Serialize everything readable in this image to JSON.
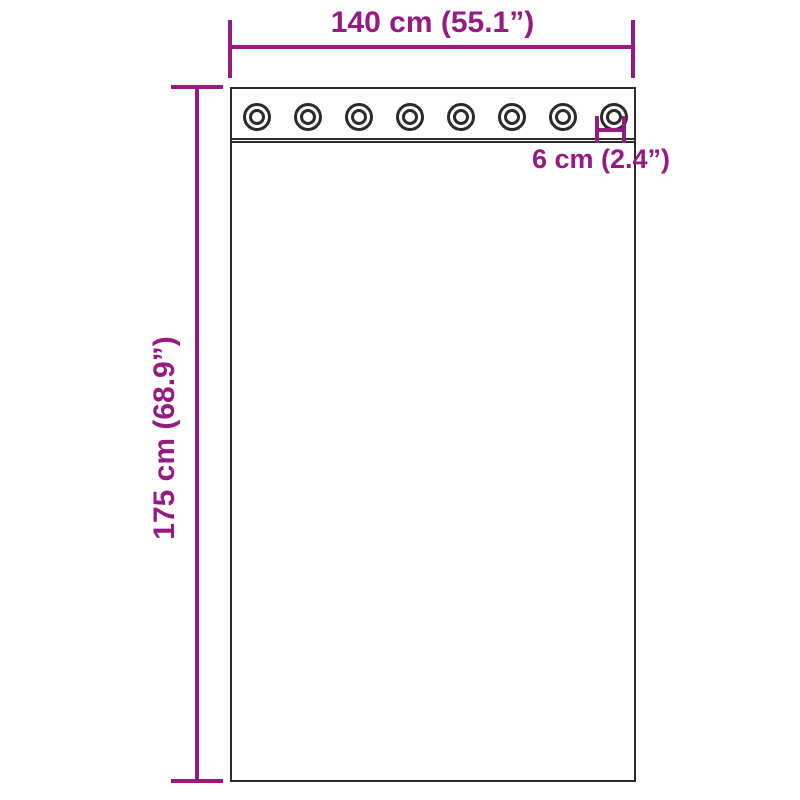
{
  "diagram": {
    "type": "curtain-grommet-dimension-diagram",
    "colors": {
      "dimension_accent": "#951b81",
      "outline": "#2b2b2b",
      "background": "#ffffff"
    },
    "grommet_row": {
      "count": 8
    },
    "dimensions": {
      "width_label": "140 cm (55.1”)",
      "height_label": "175 cm (68.9”)",
      "grommet_diameter_label": "6 cm (2.4”)"
    }
  }
}
